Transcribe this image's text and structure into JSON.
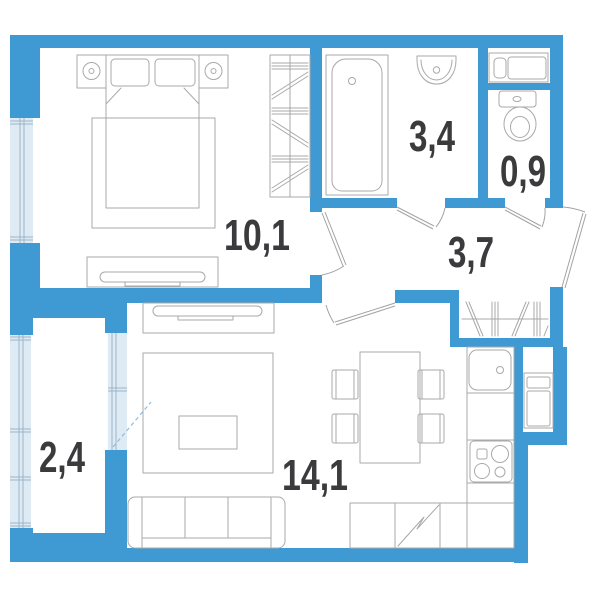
{
  "title": "One-room apartment floor plan",
  "colors": {
    "wall": "#3F99D3",
    "glazing": "#DEEBF5",
    "frame": "#9DB4C6",
    "furniture": "#A9A9A9",
    "door": "#A3A3A3",
    "swing": "#93BBDC",
    "label": "#3B3B3D"
  },
  "rooms": [
    {
      "id": "bedroom",
      "area_label": "10,1"
    },
    {
      "id": "bathroom",
      "area_label": "3,4"
    },
    {
      "id": "wc",
      "area_label": "0,9"
    },
    {
      "id": "hallway",
      "area_label": "3,7"
    },
    {
      "id": "balcony",
      "area_label": "2,4"
    },
    {
      "id": "living-kitchen",
      "area_label": "14,1"
    }
  ]
}
